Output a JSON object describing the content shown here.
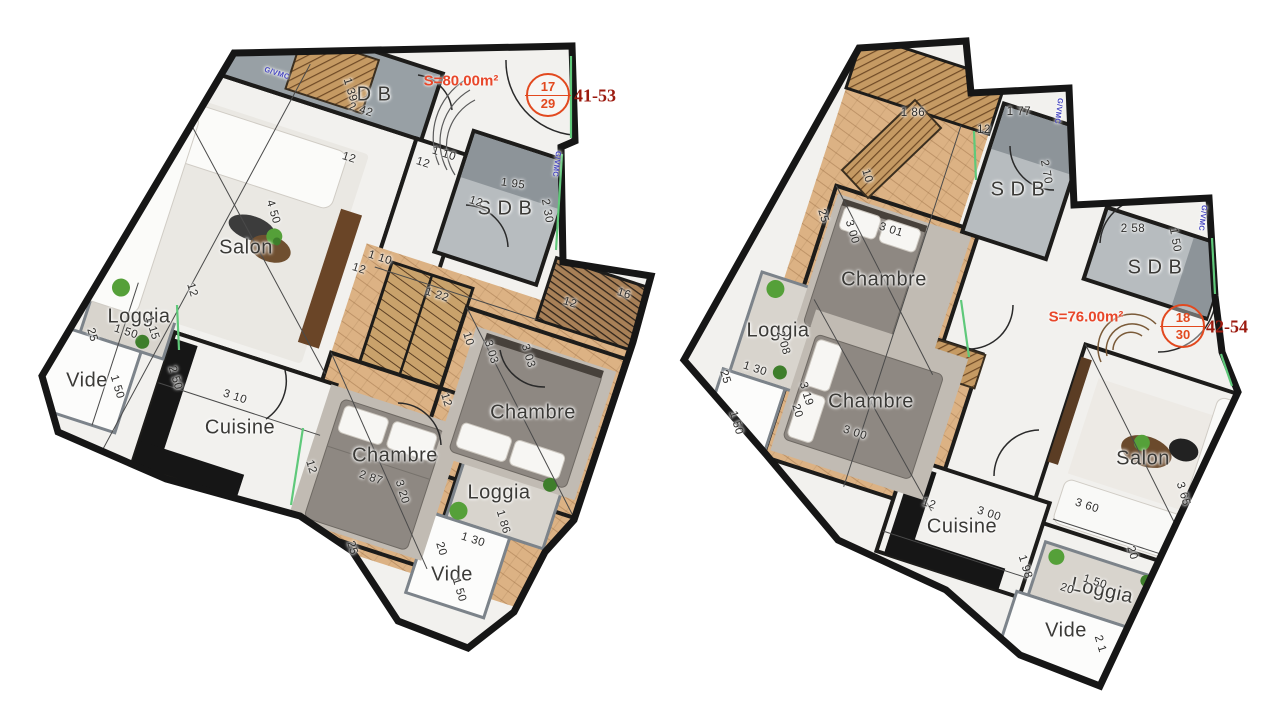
{
  "colors": {
    "area_label": "#e8472a",
    "unit_circle": "#e2491f",
    "unit_range": "#9c1a0f",
    "vmc_text": "#4646c0",
    "room_text": "#3b3a37",
    "dim_text": "#2d2c2a",
    "wall": "#1d1c1a",
    "wood_floor": "#dcb284",
    "bath_tile": "#8d9499",
    "window_green": "#5fc97a"
  },
  "plans": [
    {
      "id": "unit-17-29",
      "area_label": "S=80.00m²",
      "unit_circle": {
        "top": "17",
        "bottom": "29"
      },
      "unit_range": "41-53",
      "room_labels": [
        {
          "t": "Salon",
          "x": 246,
          "y": 248,
          "r": 0
        },
        {
          "t": "D B",
          "x": 374,
          "y": 95,
          "r": 0
        },
        {
          "t": "S D B",
          "x": 505,
          "y": 209,
          "r": 0
        },
        {
          "t": "Chambre",
          "x": 395,
          "y": 456,
          "r": 0
        },
        {
          "t": "Chambre",
          "x": 533,
          "y": 413,
          "r": 0
        },
        {
          "t": "Cuisine",
          "x": 240,
          "y": 428,
          "r": 0
        },
        {
          "t": "Loggia",
          "x": 139,
          "y": 317,
          "r": 0
        },
        {
          "t": "Loggia",
          "x": 499,
          "y": 493,
          "r": 0
        },
        {
          "t": "Vide",
          "x": 87,
          "y": 381,
          "r": 0
        },
        {
          "t": "Vide",
          "x": 452,
          "y": 575,
          "r": 0
        }
      ],
      "dim_labels": [
        {
          "t": "2 42",
          "x": 361,
          "y": 110,
          "r": 18
        },
        {
          "t": "1 39",
          "x": 350,
          "y": 90,
          "r": 73
        },
        {
          "t": "12",
          "x": 349,
          "y": 158,
          "r": 18
        },
        {
          "t": "1 10",
          "x": 444,
          "y": 154,
          "r": 18
        },
        {
          "t": "12",
          "x": 423,
          "y": 163,
          "r": 18
        },
        {
          "t": "1 95",
          "x": 513,
          "y": 184,
          "r": 8
        },
        {
          "t": "12",
          "x": 476,
          "y": 202,
          "r": 18
        },
        {
          "t": "2 30",
          "x": 547,
          "y": 211,
          "r": 80
        },
        {
          "t": "4 50",
          "x": 273,
          "y": 212,
          "r": 73
        },
        {
          "t": "12",
          "x": 192,
          "y": 290,
          "r": 73
        },
        {
          "t": "1 10",
          "x": 380,
          "y": 258,
          "r": 18
        },
        {
          "t": "12",
          "x": 359,
          "y": 269,
          "r": 18
        },
        {
          "t": "1 22",
          "x": 437,
          "y": 295,
          "r": 18
        },
        {
          "t": "10",
          "x": 468,
          "y": 339,
          "r": 73
        },
        {
          "t": "3 03",
          "x": 491,
          "y": 352,
          "r": 73
        },
        {
          "t": "3 03",
          "x": 528,
          "y": 356,
          "r": 73
        },
        {
          "t": "12",
          "x": 446,
          "y": 400,
          "r": 73
        },
        {
          "t": "12",
          "x": 570,
          "y": 303,
          "r": 18
        },
        {
          "t": "16",
          "x": 624,
          "y": 294,
          "r": 18
        },
        {
          "t": "2 87",
          "x": 371,
          "y": 478,
          "r": 18
        },
        {
          "t": "3 20",
          "x": 402,
          "y": 492,
          "r": 73
        },
        {
          "t": "12",
          "x": 311,
          "y": 467,
          "r": 73
        },
        {
          "t": "25",
          "x": 352,
          "y": 548,
          "r": 73
        },
        {
          "t": "1 86",
          "x": 503,
          "y": 522,
          "r": 73
        },
        {
          "t": "1 30",
          "x": 473,
          "y": 540,
          "r": 18
        },
        {
          "t": "20",
          "x": 441,
          "y": 549,
          "r": 73
        },
        {
          "t": "1 50",
          "x": 459,
          "y": 590,
          "r": 73
        },
        {
          "t": "1 50",
          "x": 126,
          "y": 332,
          "r": 18
        },
        {
          "t": "1 15",
          "x": 152,
          "y": 328,
          "r": 73
        },
        {
          "t": "25",
          "x": 92,
          "y": 335,
          "r": 73
        },
        {
          "t": "1 50",
          "x": 117,
          "y": 387,
          "r": 73
        },
        {
          "t": "2 50",
          "x": 175,
          "y": 378,
          "r": 73
        },
        {
          "t": "3 10",
          "x": 235,
          "y": 397,
          "r": 18
        }
      ],
      "vmc_labels": [
        {
          "t": "G/VMC",
          "x": 277,
          "y": 73,
          "r": 18
        },
        {
          "t": "G/VMC",
          "x": 557,
          "y": 164,
          "r": 97
        }
      ]
    },
    {
      "id": "unit-18-30",
      "area_label": "S=76.00m²",
      "unit_circle": {
        "top": "18",
        "bottom": "30"
      },
      "unit_range": "42-54",
      "room_labels": [
        {
          "t": "Chambre",
          "x": 884,
          "y": 280,
          "r": 0
        },
        {
          "t": "Chambre",
          "x": 871,
          "y": 402,
          "r": 0
        },
        {
          "t": "Salon",
          "x": 1143,
          "y": 459,
          "r": 0
        },
        {
          "t": "Cuisine",
          "x": 962,
          "y": 527,
          "r": 0
        },
        {
          "t": "Loggia",
          "x": 778,
          "y": 331,
          "r": 0
        },
        {
          "t": "Loggia",
          "x": 1102,
          "y": 591,
          "r": 12
        },
        {
          "t": "Vide",
          "x": 1066,
          "y": 631,
          "r": 0
        },
        {
          "t": "S D B",
          "x": 1018,
          "y": 190,
          "r": 0
        },
        {
          "t": "S D B",
          "x": 1155,
          "y": 268,
          "r": 0
        }
      ],
      "dim_labels": [
        {
          "t": "1 86",
          "x": 913,
          "y": 113,
          "r": 0
        },
        {
          "t": "1 77",
          "x": 1019,
          "y": 112,
          "r": 0
        },
        {
          "t": "12",
          "x": 984,
          "y": 130,
          "r": 0
        },
        {
          "t": "2 70",
          "x": 1046,
          "y": 172,
          "r": 80
        },
        {
          "t": "2 58",
          "x": 1133,
          "y": 229,
          "r": 0
        },
        {
          "t": "1 50",
          "x": 1175,
          "y": 240,
          "r": 80
        },
        {
          "t": "10",
          "x": 867,
          "y": 176,
          "r": 73
        },
        {
          "t": "25",
          "x": 823,
          "y": 216,
          "r": 73
        },
        {
          "t": "3 00",
          "x": 852,
          "y": 232,
          "r": 73
        },
        {
          "t": "3 01",
          "x": 891,
          "y": 230,
          "r": 18
        },
        {
          "t": "2 08",
          "x": 783,
          "y": 343,
          "r": 73
        },
        {
          "t": "1 30",
          "x": 755,
          "y": 369,
          "r": 18
        },
        {
          "t": "25",
          "x": 725,
          "y": 377,
          "r": 73
        },
        {
          "t": "1 50",
          "x": 736,
          "y": 423,
          "r": 73
        },
        {
          "t": "3 19",
          "x": 806,
          "y": 394,
          "r": 73
        },
        {
          "t": "20",
          "x": 797,
          "y": 411,
          "r": 73
        },
        {
          "t": "3 00",
          "x": 855,
          "y": 433,
          "r": 18
        },
        {
          "t": "12",
          "x": 929,
          "y": 504,
          "r": 18
        },
        {
          "t": "3 00",
          "x": 989,
          "y": 514,
          "r": 18
        },
        {
          "t": "1 98",
          "x": 1025,
          "y": 567,
          "r": 73
        },
        {
          "t": "20",
          "x": 1132,
          "y": 553,
          "r": 73
        },
        {
          "t": "3 60",
          "x": 1087,
          "y": 506,
          "r": 18
        },
        {
          "t": "3 65",
          "x": 1183,
          "y": 494,
          "r": 73
        },
        {
          "t": "20",
          "x": 1067,
          "y": 589,
          "r": 18
        },
        {
          "t": "1 50",
          "x": 1095,
          "y": 582,
          "r": 18
        },
        {
          "t": "2 1",
          "x": 1100,
          "y": 644,
          "r": 73
        }
      ],
      "vmc_labels": [
        {
          "t": "G/VMC",
          "x": 1059,
          "y": 111,
          "r": 97
        },
        {
          "t": "G/VMC",
          "x": 1203,
          "y": 218,
          "r": 97
        }
      ]
    }
  ]
}
